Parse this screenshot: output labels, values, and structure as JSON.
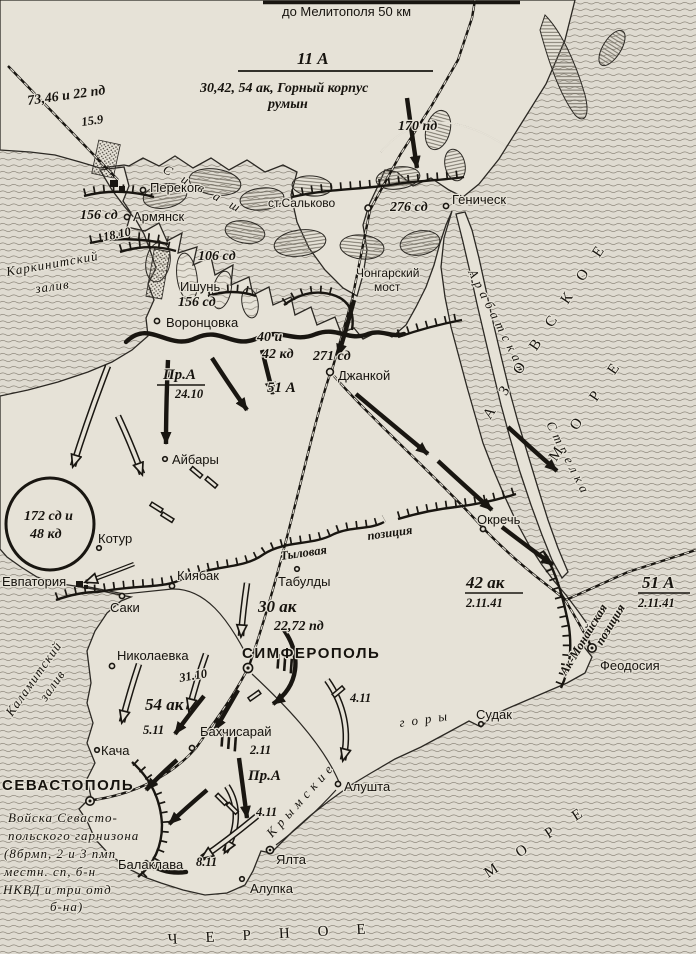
{
  "title_note": "до Мелитополя 50 км",
  "army_header": {
    "name": "11 А",
    "composition": "30,42, 54 ак, Горный корпус",
    "composition2": "румын"
  },
  "units": {
    "nw_divisions": "73,46 и 22 пд",
    "nw_date": "15.9",
    "pd170": "170 пд",
    "sd276": "276 сд",
    "sd156_perekop": "156 сд",
    "sd156_ishun": "156 сд",
    "sd106": "106 сд",
    "sd271": "271 сд",
    "kd_line1": "40 и",
    "kd_line2": "42 кд",
    "a51": "51 А",
    "prA": "Пр.А",
    "prA_date": "24.10",
    "pocket_line1": "172 сд и",
    "pocket_line2": "48 кд",
    "ak30": "30 ак",
    "ak30_divs": "22,72 пд",
    "ak42": "42 ак",
    "ak42_date": "2.11.41",
    "a51_east": "51 А",
    "a51_east_date": "2.11.41",
    "ak54": "54 ак",
    "prA_south": "Пр.А"
  },
  "dates": {
    "d18_10": "18.10",
    "d31_10": "31.10",
    "d5_11": "5.11",
    "d2_11": "2.11",
    "d4_11_alushta": "4.11",
    "d4_11_yalta": "4.11",
    "d8_11": "8.11"
  },
  "garrison": [
    "Войска Севасто-",
    "польского гарнизона",
    "(8брмп, 2 и 3 пмп",
    "местн. сп, б-н",
    "НКВД и три отд",
    "б-на)"
  ],
  "places": {
    "perekop": "Перекоп",
    "armyansk": "Армянск",
    "salkovo": "ст.Сальково",
    "genichesk": "Геническ",
    "chongar_line1": "Чонгарский",
    "chongar_line2": "мост",
    "ishun": "Ишунь",
    "vorontsovka": "Воронцовка",
    "dzhankoy": "Джанкой",
    "aybary": "Айбары",
    "kotur": "Котур",
    "evpatoria": "Евпатория",
    "saki": "Саки",
    "kiyabak": "Киябак",
    "tabuldy": "Табулды",
    "okrech": "Окречь",
    "feodosia": "Феодосия",
    "simferopol": "СИМФЕРОПОЛЬ",
    "nikolaevka": "Николаевка",
    "kacha": "Кача",
    "bakhchisarai": "Бахчисарай",
    "sudak": "Судак",
    "alushta": "Алушта",
    "sevastopol": "СЕВАСТОПОЛЬ",
    "balaklava": "Балаклава",
    "yalta": "Ялта",
    "alupka": "Алупка"
  },
  "geo": {
    "karkinit_line1": "Каркинитский",
    "karkinit_line2": "залив",
    "kalamit_line1": "Каламитский",
    "kalamit_line2": "залив",
    "sivash": "Сиваш",
    "arabat_line1": "Арабатская",
    "arabat_line2": "Стрелка",
    "azov_sea": "АЗОВСКОЕ",
    "azov_sea2": "МОРЕ",
    "black_sea": "ЧЕРНОЕ",
    "black_sea2": "МОРЕ",
    "mountains_line1": "Крымские",
    "mountains_line2": "горы"
  },
  "positions": {
    "rear_1": "Тыловая",
    "rear_2": "позиция",
    "akmonai_1": "Ак-Монайская",
    "akmonai_2": "позиция"
  }
}
